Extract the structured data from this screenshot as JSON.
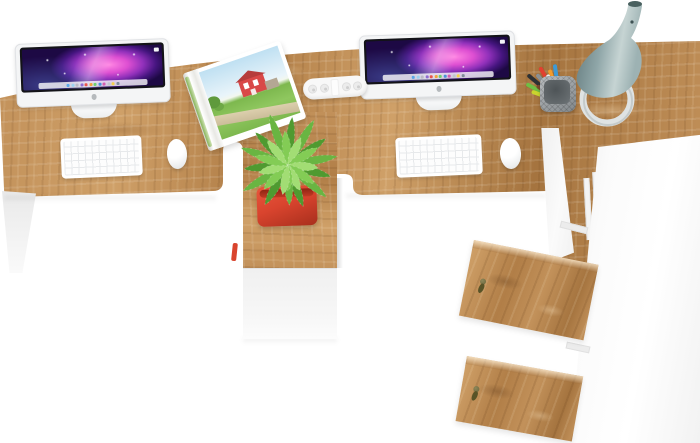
{
  "meta": {
    "title": "Two-person office workstation with iMacs — top view product photo",
    "visible_text": [],
    "objects": [
      "wooden double desk top",
      "center wooden pedestal with plant",
      "left iMac",
      "right iMac",
      "left white keyboard",
      "right white keyboard",
      "left white mouse",
      "right white mouse",
      "open magazine with red barn photo",
      "white pill-shaped desk connector",
      "pencil cup with colored pencils",
      "gray-teal vase lamp on white ring stand",
      "green potted plant in red pot",
      "white under-desk cabinet box",
      "tall white side cabinet",
      "two open oak cabinet doors with keys",
      "white desk legs"
    ]
  },
  "colors": {
    "background": "#ffffff",
    "wood-light": "#cfa068",
    "wood-mid": "#c2915a",
    "wood-dark": "#b17e47",
    "wood-dark2": "#a5743f",
    "screen-bezel": "#131318",
    "imac-body": "#f4f5f6",
    "wall-pink": "#ff85e3",
    "wall-magenta": "#de4fd2",
    "wall-purple": "#9030ba",
    "wall-deep": "#45157f",
    "wall-dark": "#1d0944",
    "pot-red": "#d9442e",
    "plant-dark": "#4f9a30",
    "plant-mid": "#69b542",
    "plant-light": "#83cc55",
    "plant-pale": "#a2dd74",
    "lamp-light": "#c6d4d3",
    "lamp-mid": "#8fa6a8",
    "lamp-dark": "#5d7477",
    "ring-gray": "#dfe3e3",
    "mag-sky": "#bfe0f2",
    "mag-grass": "#7db84e",
    "mag-barn": "#d94848",
    "mag-path": "#dccfad",
    "key-bronze": "#6a653a",
    "key-tassel": "#585327",
    "shadow": "rgba(70,55,40,0.18)"
  },
  "dock_icons": [
    "#5aa7e8",
    "#9bd1f0",
    "#b9b9c4",
    "#8e6bd0",
    "#e8554d",
    "#f2a33c",
    "#6fcf6f",
    "#4a90d9",
    "#d45db0",
    "#c0c6cc",
    "#f5d04a",
    "#7f8c99"
  ],
  "pencils": [
    {
      "color": "#6fbe44",
      "angle": -62,
      "len": 38
    },
    {
      "color": "#2d3134",
      "angle": -50,
      "len": 42
    },
    {
      "color": "#8a9094",
      "angle": -40,
      "len": 36
    },
    {
      "color": "#e2402f",
      "angle": -30,
      "len": 40
    },
    {
      "color": "#f39c2d",
      "angle": -18,
      "len": 34
    },
    {
      "color": "#3f9ad6",
      "angle": -8,
      "len": 38
    },
    {
      "color": "#c9d42e",
      "angle": -70,
      "len": 30
    },
    {
      "color": "#efefef",
      "angle": -25,
      "len": 30
    },
    {
      "color": "#7a4a2b",
      "angle": -55,
      "len": 28
    }
  ],
  "plant_blades": [
    {
      "a": -150,
      "l": 46,
      "c": 0
    },
    {
      "a": -120,
      "l": 52,
      "c": 1
    },
    {
      "a": -95,
      "l": 44,
      "c": 0
    },
    {
      "a": -70,
      "l": 50,
      "c": 1
    },
    {
      "a": -45,
      "l": 46,
      "c": 0
    },
    {
      "a": -20,
      "l": 54,
      "c": 1
    },
    {
      "a": 5,
      "l": 48,
      "c": 0
    },
    {
      "a": 30,
      "l": 52,
      "c": 1
    },
    {
      "a": 55,
      "l": 46,
      "c": 0
    },
    {
      "a": 80,
      "l": 50,
      "c": 1
    },
    {
      "a": 105,
      "l": 44,
      "c": 0
    },
    {
      "a": 130,
      "l": 50,
      "c": 1
    },
    {
      "a": 160,
      "l": 44,
      "c": 0
    },
    {
      "a": 178,
      "l": 40,
      "c": 1
    },
    {
      "a": -135,
      "l": 34,
      "c": 2
    },
    {
      "a": -105,
      "l": 30,
      "c": 3
    },
    {
      "a": -75,
      "l": 34,
      "c": 2
    },
    {
      "a": -40,
      "l": 32,
      "c": 3
    },
    {
      "a": -5,
      "l": 34,
      "c": 2
    },
    {
      "a": 25,
      "l": 30,
      "c": 3
    },
    {
      "a": 60,
      "l": 34,
      "c": 2
    },
    {
      "a": 95,
      "l": 30,
      "c": 3
    },
    {
      "a": 125,
      "l": 32,
      "c": 2
    },
    {
      "a": 155,
      "l": 28,
      "c": 3
    },
    {
      "a": 180,
      "l": 26,
      "c": 2
    },
    {
      "a": -170,
      "l": 30,
      "c": 3
    }
  ]
}
